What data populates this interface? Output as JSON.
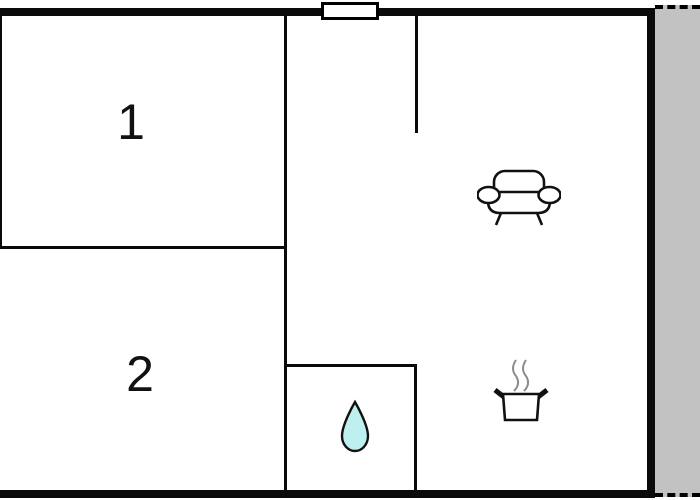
{
  "floorplan": {
    "rooms": [
      {
        "name": "room-1",
        "label": "1"
      },
      {
        "name": "room-2",
        "label": "2"
      }
    ],
    "features": [
      {
        "name": "living-area",
        "icon": "sofa-icon"
      },
      {
        "name": "kitchen",
        "icon": "cooking-pot-icon"
      },
      {
        "name": "bathroom",
        "icon": "water-drop-icon"
      },
      {
        "name": "terrace",
        "icon": "terrace-strip"
      },
      {
        "name": "entry-window",
        "icon": "window-marker"
      }
    ],
    "colors": {
      "wall": "#0a0a0a",
      "terrace_fill": "#c2c2c2",
      "water_drop_fill": "#bff0f0",
      "steam": "#8c8c8c",
      "background": "#ffffff"
    }
  }
}
